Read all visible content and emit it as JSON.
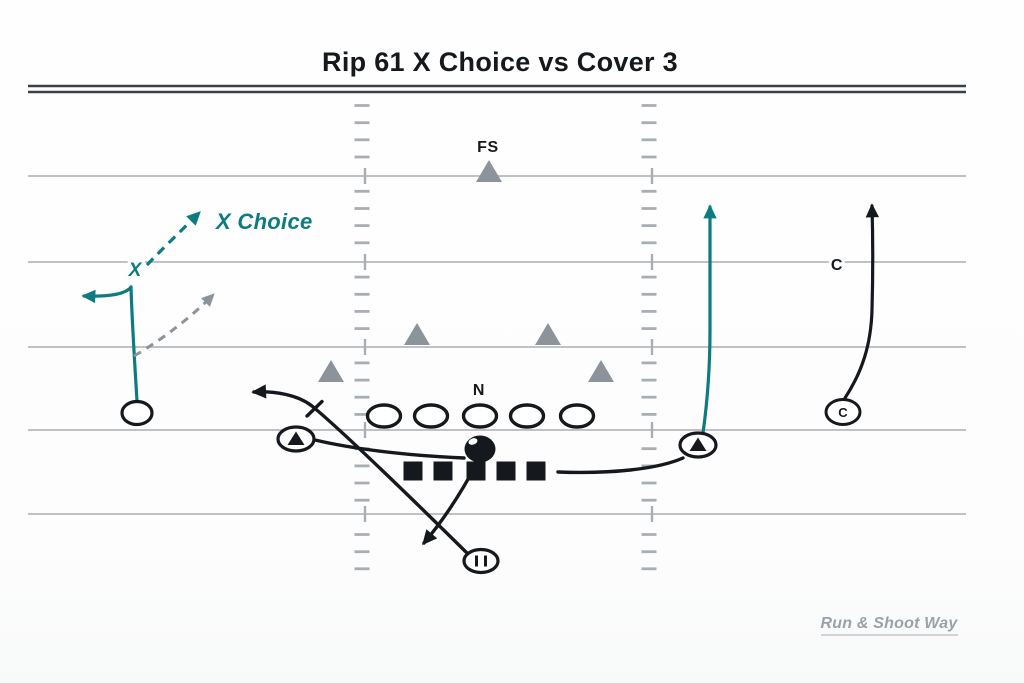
{
  "title": "Rip 61 X Choice vs Cover 3",
  "watermark": "Run & Shoot Way",
  "play": {
    "route_label": "X Choice",
    "receiver_label": "X",
    "running_back_mark": "II"
  },
  "defense": {
    "free_safety_label": "FS",
    "nose_label": "N",
    "corner_drop_label": "C",
    "corner_circle_label": "C"
  },
  "colors": {
    "ink": "#15181c",
    "accent_teal": "#0e7b80",
    "defense_gray": "#8d939a",
    "option_gray": "#8d939a",
    "field_line": "#b6b9bc",
    "goal_line": "#3a4149",
    "hash_mark": "#a9aeb3",
    "watermark_gray": "#9aa1a8",
    "watermark_underline": "#c3c7cb"
  },
  "players": [
    {
      "name": "free-safety-triangle",
      "symbol": "triangle",
      "x": 489,
      "y": 171
    },
    {
      "name": "linebacker-left-triangle",
      "symbol": "triangle",
      "x": 417,
      "y": 334
    },
    {
      "name": "linebacker-right-triangle",
      "symbol": "triangle",
      "x": 548,
      "y": 334
    },
    {
      "name": "overhang-left-triangle",
      "symbol": "triangle",
      "x": 331,
      "y": 371
    },
    {
      "name": "overhang-right-triangle",
      "symbol": "triangle",
      "x": 601,
      "y": 371
    },
    {
      "name": "offensive-lineman",
      "symbol": "oval",
      "x": 384,
      "y": 416
    },
    {
      "name": "offensive-lineman",
      "symbol": "oval",
      "x": 431,
      "y": 416
    },
    {
      "name": "offensive-lineman",
      "symbol": "oval",
      "x": 480,
      "y": 416
    },
    {
      "name": "offensive-lineman",
      "symbol": "oval",
      "x": 527,
      "y": 416
    },
    {
      "name": "offensive-lineman",
      "symbol": "oval",
      "x": 577,
      "y": 416
    },
    {
      "name": "quarterback",
      "symbol": "filled-oval",
      "x": 480,
      "y": 449
    },
    {
      "name": "protection-square",
      "symbol": "square",
      "x": 413,
      "y": 471
    },
    {
      "name": "protection-square",
      "symbol": "square",
      "x": 443,
      "y": 471
    },
    {
      "name": "protection-square",
      "symbol": "square",
      "x": 476,
      "y": 471
    },
    {
      "name": "protection-square",
      "symbol": "square",
      "x": 506,
      "y": 471
    },
    {
      "name": "protection-square",
      "symbol": "square",
      "x": 536,
      "y": 471
    },
    {
      "name": "x-receiver",
      "symbol": "circle",
      "x": 137,
      "y": 413
    },
    {
      "name": "left-slot",
      "symbol": "circle-triangle",
      "x": 296,
      "y": 439
    },
    {
      "name": "right-slot",
      "symbol": "circle-triangle",
      "x": 698,
      "y": 445
    },
    {
      "name": "running-back",
      "symbol": "circle-bars",
      "x": 481,
      "y": 561
    },
    {
      "name": "cornerback-right",
      "symbol": "circle-letter",
      "x": 843,
      "y": 412,
      "label": "C"
    }
  ],
  "routes": [
    {
      "name": "x-choice-stem",
      "color": "teal",
      "width": 3.2,
      "dash": "",
      "path": "M137,401 C135,368 132,322 131,287",
      "marker": false
    },
    {
      "name": "x-choice-out-branch",
      "color": "teal",
      "width": 3.2,
      "dash": "",
      "path": "M131,287 C126,294 109,297 84,296",
      "marker": true
    },
    {
      "name": "x-choice-upfield-dashed",
      "color": "teal",
      "width": 3.2,
      "dash": "9,6.5",
      "path": "M147,265 C160,251 186,226 199,213",
      "marker": true
    },
    {
      "name": "x-choice-option-dashed",
      "color": "gray",
      "width": 3,
      "dash": "8,6.5",
      "path": "M134,356 Q178,330 213,295",
      "marker": true
    },
    {
      "name": "right-slot-seam",
      "color": "teal",
      "width": 3.2,
      "dash": "",
      "path": "M703,433 C708,397 710,363 710,330 L710,207",
      "marker": true
    },
    {
      "name": "cornerback-bail",
      "color": "ink",
      "width": 3.2,
      "dash": "",
      "path": "M845,398 C862,372 871,345 872,310 C873,274 873,240 872,206",
      "marker": true
    },
    {
      "name": "left-slot-connector",
      "color": "ink",
      "width": 3.4,
      "dash": "",
      "path": "M315,440 C362,451 422,456 464,458",
      "marker": false
    },
    {
      "name": "right-slot-connector",
      "color": "ink",
      "width": 3.4,
      "dash": "",
      "path": "M558,472 C612,474 658,469 683,458",
      "marker": false
    },
    {
      "name": "back-block-release",
      "color": "ink",
      "width": 3.4,
      "dash": "",
      "path": "M467,553 C395,482 335,425 312,406 C298,395 276,391 254,392",
      "marker": true
    },
    {
      "name": "block-tick",
      "color": "ink",
      "width": 3.4,
      "dash": "",
      "path": "M322,401.5 L307,416",
      "marker": false
    },
    {
      "name": "qb-drop",
      "color": "ink",
      "width": 3.4,
      "dash": "",
      "path": "M477,463 Q452,510 424,543",
      "marker": true
    }
  ]
}
